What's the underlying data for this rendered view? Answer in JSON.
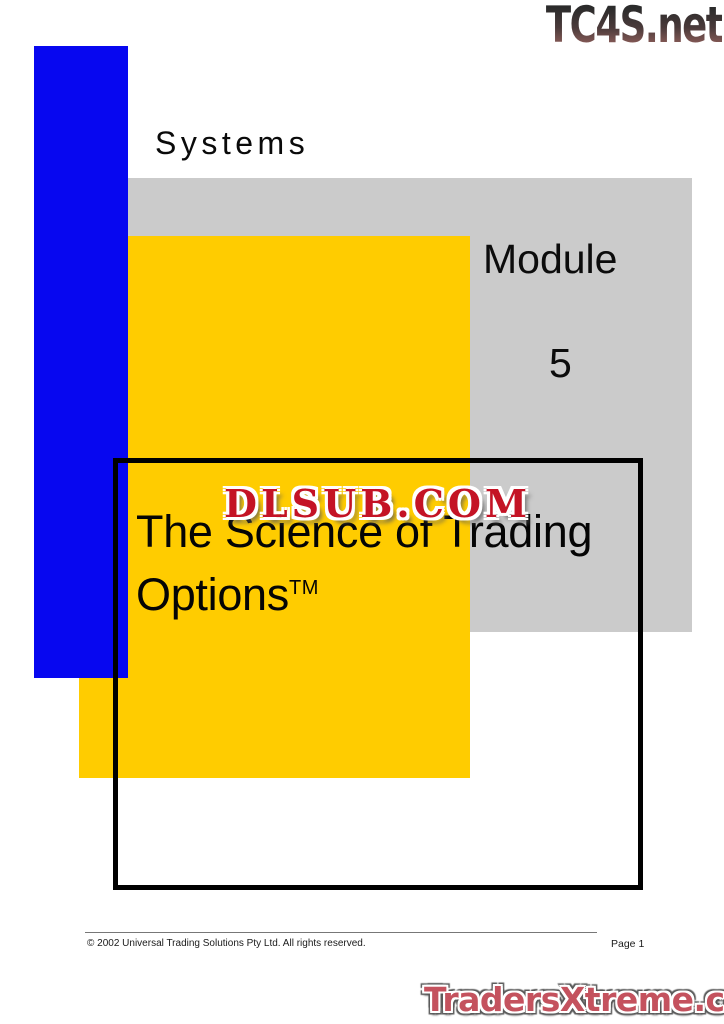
{
  "header": {
    "eyebrow": "Systems"
  },
  "module": {
    "label": "Module",
    "number": "5"
  },
  "title": {
    "line1": "The Science of Trading",
    "line2": "Options",
    "trademark": "TM"
  },
  "watermarks": {
    "top_logo": "TC4S.net",
    "center_logo": "DLSUB.COM",
    "bottom_logo": "TradersXtreme.com"
  },
  "footer": {
    "copyright": "© 2002 Universal Trading Solutions Pty Ltd. All rights reserved.",
    "page_label": "Page 1"
  },
  "colors": {
    "accent_blue": "#0707f0",
    "accent_yellow": "#ffcc00",
    "panel_gray": "#cbcbcb",
    "watermark_red": "#c41325",
    "logo_red": "#c4525e"
  }
}
